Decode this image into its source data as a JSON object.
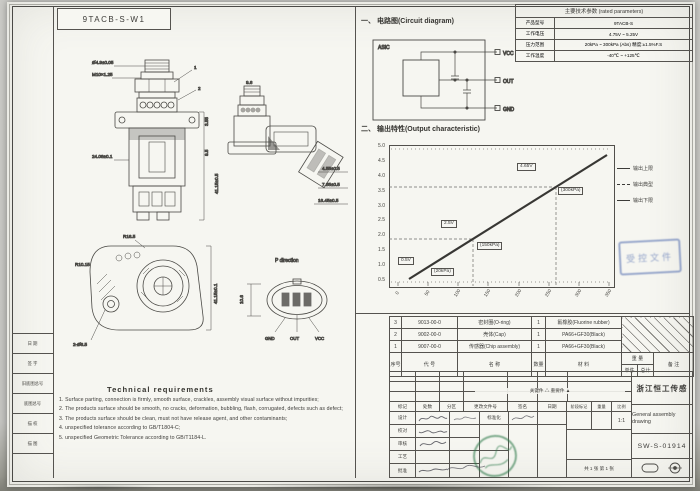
{
  "frame": {
    "part_no": "9TACB-S-W1",
    "left_table_rows": [
      "日 期",
      "签 字",
      "旧底图总号",
      "底图总号",
      "描 校",
      "描 图",
      ""
    ]
  },
  "params": {
    "title": "主要技术参数 (rated parameters)",
    "rows": [
      {
        "label": "产品型号",
        "value": "9TACB-S"
      },
      {
        "label": "工作电压",
        "value": "4.75V ~ 5.25V"
      },
      {
        "label": "压力范围",
        "value": "20kPa ~ 300kPa (Abs) 精度:±1.5%F.S"
      },
      {
        "label": "工作温度",
        "value": "-40℃ ~ +125℃"
      }
    ]
  },
  "circuit": {
    "title": "一、 电路图(Circuit diagram)",
    "chip_label": "ASIC",
    "terminals": [
      "VCC",
      "OUT",
      "GND"
    ]
  },
  "chart": {
    "heading": "二、 输出特性(Output characteristic)"
  },
  "chart_data": {
    "type": "line",
    "title": "输出特性 (Output characteristic)",
    "xlabel": "压力 (kPa)",
    "ylabel": "输出电压 (V)",
    "x_ticks": [
      "0",
      "50",
      "100",
      "150",
      "200",
      "250",
      "300",
      "350"
    ],
    "y_ticks": [
      "5.0",
      "4.5",
      "4.0",
      "3.5",
      "3.0",
      "2.5",
      "2.0",
      "1.5",
      "1.0",
      "0.5"
    ],
    "xlim": [
      0,
      350
    ],
    "ylim": [
      0.5,
      5.0
    ],
    "grid": "dashed reference lines at annotated points, dotted top/bottom rows",
    "legend_position": "right",
    "legend": [
      "输出上限",
      "输出典型",
      "输出下限"
    ],
    "series": [
      {
        "name": "输出典型",
        "points": [
          [
            20,
            0.5
          ],
          [
            150,
            2.5
          ],
          [
            300,
            4.65
          ]
        ]
      }
    ],
    "annotations": [
      {
        "text": "0.5V",
        "x": 20,
        "y": 0.5
      },
      {
        "text": "(20kPa)",
        "x": 20,
        "y": 0.5
      },
      {
        "text": "2.5V",
        "x": 150,
        "y": 2.5
      },
      {
        "text": "(150kPa)",
        "x": 150,
        "y": 2.5
      },
      {
        "text": "4.65V",
        "x": 300,
        "y": 4.65
      },
      {
        "text": "(300kPa)",
        "x": 300,
        "y": 4.65
      }
    ]
  },
  "stamps": {
    "controlled": "受控文件"
  },
  "views": {
    "front": {
      "dims": [
        "Ø4.9±0.05",
        "M10×1.25",
        "24.08±0.1",
        "3.55",
        "9.5",
        "41.15±0.5",
        "1",
        "2"
      ]
    },
    "side": {
      "dims": [
        "9.6",
        "4.55±0.5",
        "7.85±0.5",
        "16.45±0.5"
      ]
    },
    "top": {
      "dims": [
        "R16.5",
        "R10.15",
        "41.15±0.1",
        "2-Ø6.5"
      ]
    },
    "p": {
      "label": "P direction",
      "dim": "10.6",
      "pins": [
        "GND",
        "OUT",
        "VCC"
      ]
    }
  },
  "tech": {
    "heading": "Technical requirements",
    "items": [
      "1. Surface parting, connection is firmly, smooth surface, crackles, assembly visual surface without impurities;",
      "2. The products surface should be smooth, no cracks, deformation, bubbling, flash, corrugated, defects such as defect;",
      "3. The products surface should be clean, must not have release agent, and other contaminants;",
      "4. unspecified tolerance according to GB/T1804-C;",
      "5. unspecified Geometric Tolerance according to GB/T1184-L."
    ]
  },
  "bom": {
    "header": {
      "no": "序号",
      "code": "代  号",
      "name": "名  称",
      "qty": "数量",
      "material": "材  料",
      "weight": "重 量",
      "unit": "单件",
      "total": "总计",
      "remark": "备 注"
    },
    "rows": [
      {
        "no": "3",
        "code": "9013-00-0",
        "name": "密封圈(O-ring)",
        "qty": "1",
        "material": "氟橡胶(Fluorine rubber)"
      },
      {
        "no": "2",
        "code": "9002-00-0",
        "name": "壳体(Cap)",
        "qty": "1",
        "material": "PA66+GF30(Black)"
      },
      {
        "no": "1",
        "code": "9007-00-0",
        "name": "传感器(Chip assembly)",
        "qty": "1",
        "material": "PA66+GF30(Black)"
      }
    ]
  },
  "titleblock": {
    "company": "浙江恒工传感",
    "doc_title": "General assembly drawing",
    "drawing_no": "SW-S-01914",
    "key_parts": "关键件 △      重要件 ▲",
    "sig_header": [
      "标记",
      "处数",
      "分区",
      "更改文件号",
      "签名",
      "日期"
    ],
    "sig_rows": [
      "设计",
      "校对",
      "审核",
      "工艺",
      "批准"
    ],
    "std_label": "标准化",
    "stage_label": "阶段标记",
    "weight_label": "重量",
    "scale_label": "比例",
    "scale": "1:1",
    "sheet": "共 1 张  第 1 张"
  }
}
